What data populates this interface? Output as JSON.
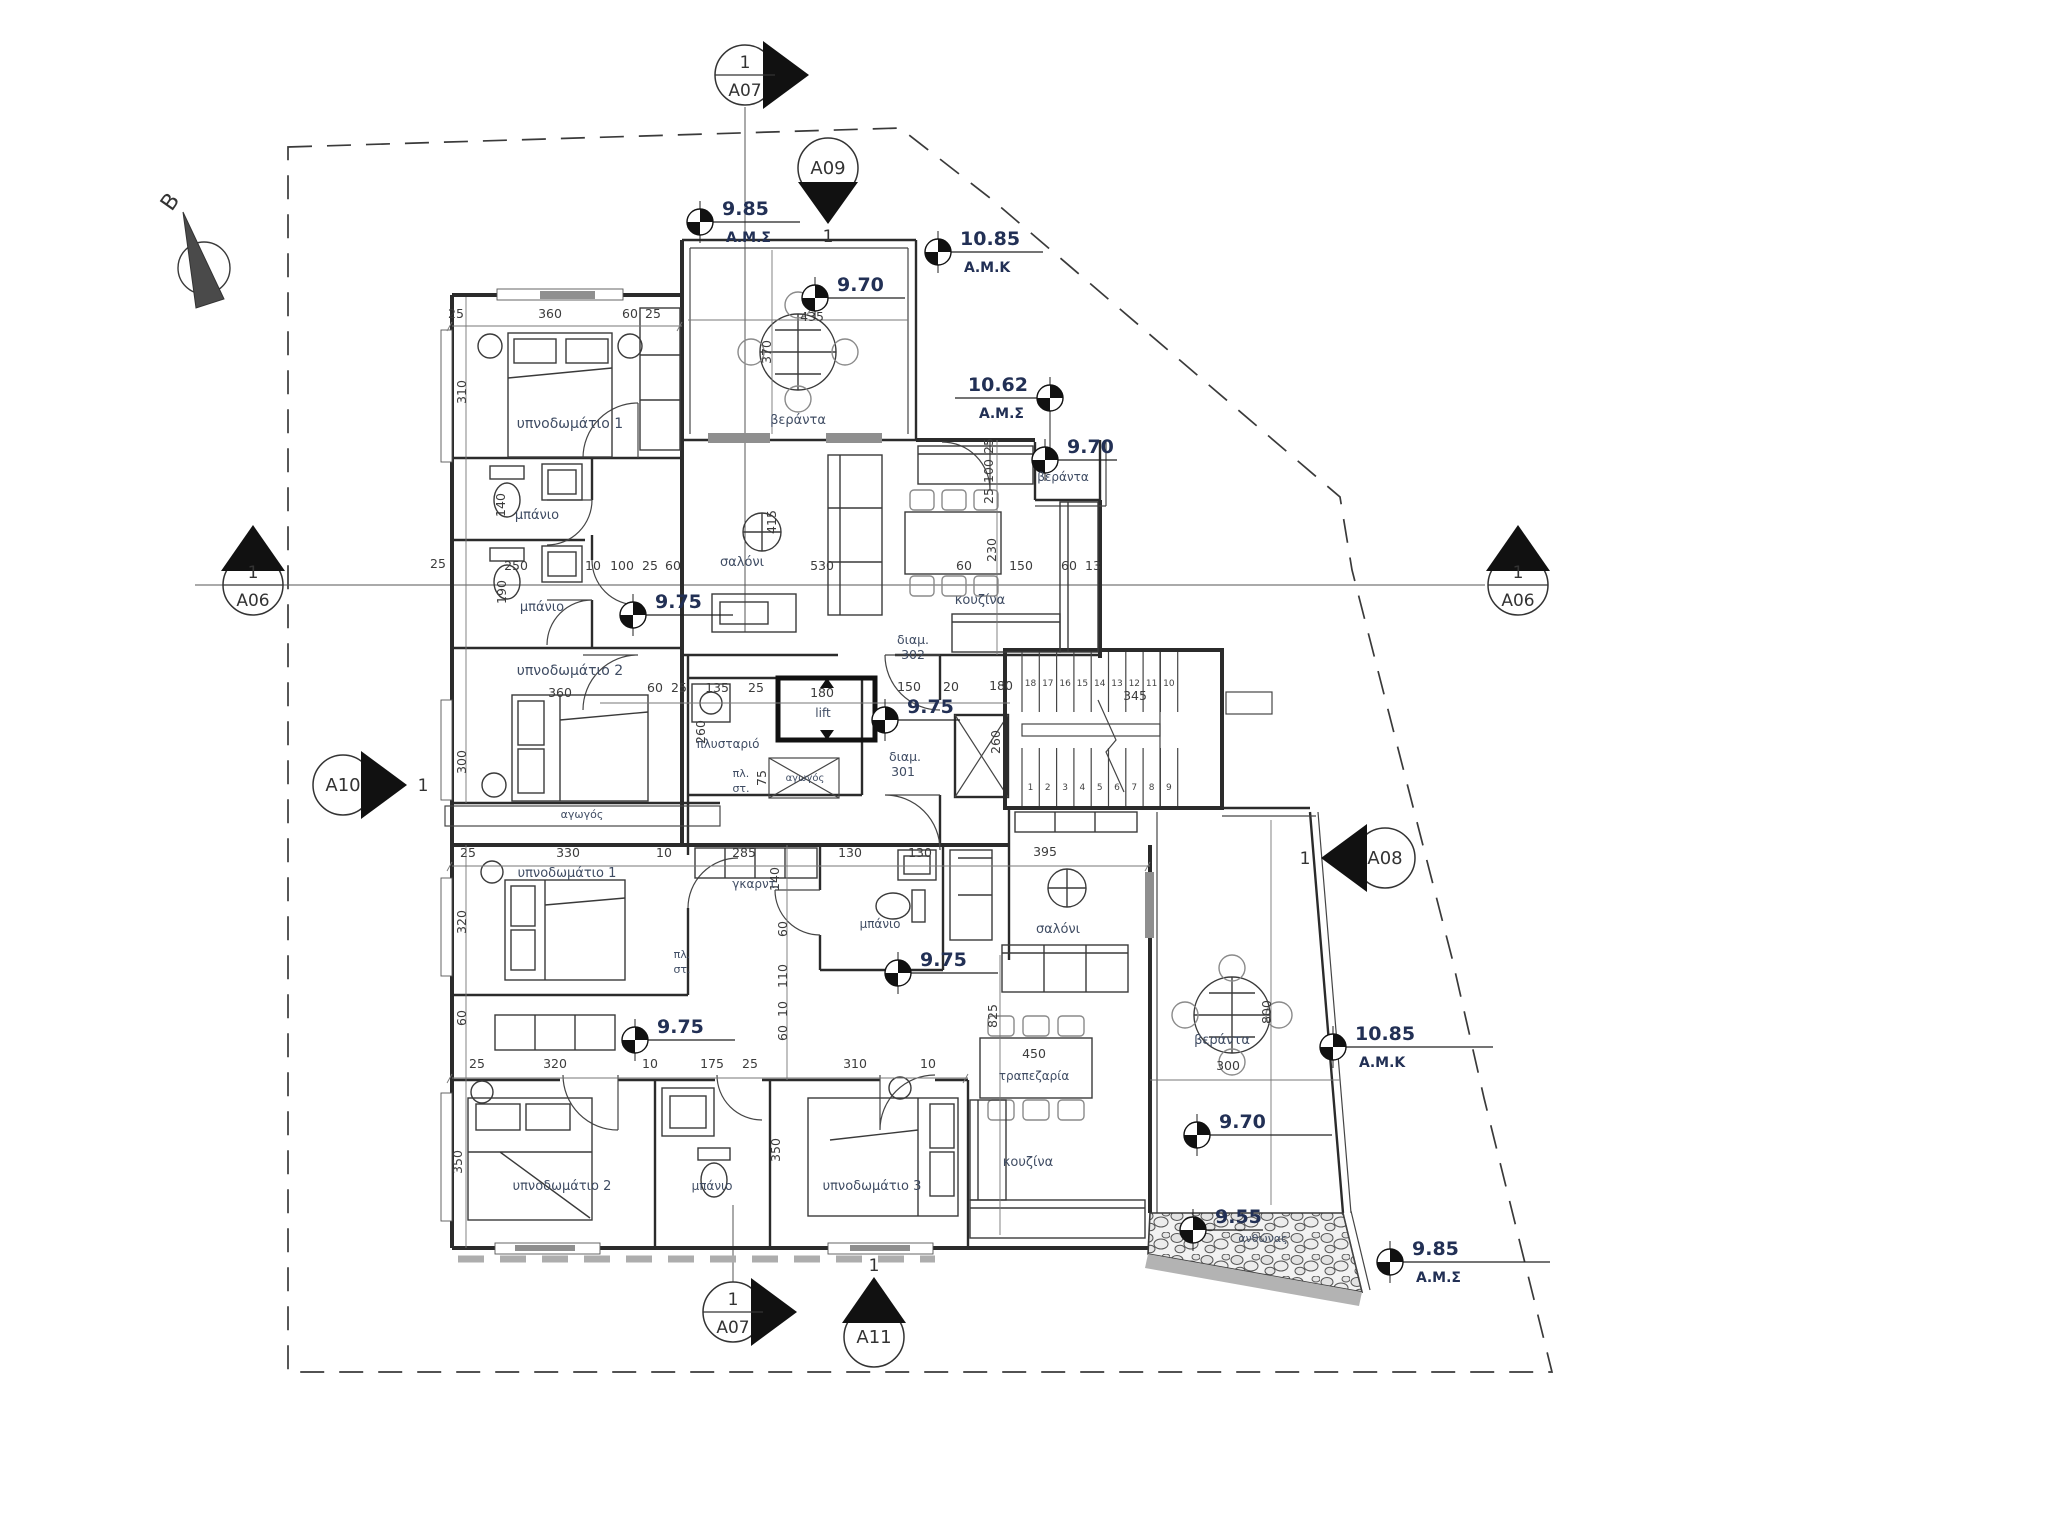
{
  "meta": {
    "kind": "architectural floor plan",
    "language": "Greek"
  },
  "north_arrow": {
    "label": "B"
  },
  "colors": {
    "background": "#ffffff",
    "line": "#2b2b2b",
    "level_text": "#223055",
    "room_label_text": "#3f4c63",
    "dimension_text": "#3c3c3c",
    "gray_fill": "#8f8f8f"
  },
  "apartments": [
    {
      "id_label": "διαμ.",
      "number": "302"
    },
    {
      "id_label": "διαμ.",
      "number": "301"
    }
  ],
  "section_markers": [
    {
      "name": "A07-top",
      "label": "A07",
      "number": "1",
      "x": 745,
      "y": 75,
      "arrow": "right",
      "divided": true,
      "line": [
        745,
        107,
        745,
        632
      ]
    },
    {
      "name": "A09",
      "label": "A09",
      "number": "1",
      "x": 828,
      "y": 168,
      "arrow": "down",
      "divided": false,
      "numpos": "below"
    },
    {
      "name": "A06-left",
      "label": "A06",
      "number": "1",
      "x": 253,
      "y": 585,
      "arrow": "up",
      "divided": true,
      "line": [
        195,
        585,
        1485,
        585
      ]
    },
    {
      "name": "A10",
      "label": "A10",
      "number": "1",
      "x": 343,
      "y": 785,
      "arrow": "right",
      "divided": false,
      "numpos": "right"
    },
    {
      "name": "A06-right",
      "label": "A06",
      "number": "1",
      "x": 1518,
      "y": 585,
      "arrow": "up",
      "divided": true
    },
    {
      "name": "A08",
      "label": "A08",
      "number": "1",
      "x": 1385,
      "y": 858,
      "arrow": "left",
      "divided": false,
      "numpos": "left"
    },
    {
      "name": "A07-bottom",
      "label": "A07",
      "number": "1",
      "x": 733,
      "y": 1312,
      "arrow": "right",
      "divided": true,
      "line": [
        733,
        1282,
        733,
        1205
      ]
    },
    {
      "name": "A11",
      "label": "A11",
      "number": "1",
      "x": 874,
      "y": 1337,
      "arrow": "up",
      "divided": false,
      "numpos": "above"
    }
  ],
  "level_markers": [
    {
      "value": "9.85",
      "datum": "Α.Μ.Σ",
      "x": 700,
      "y": 222,
      "dir": "right",
      "len": 100
    },
    {
      "value": "10.85",
      "datum": "Α.Μ.Κ",
      "x": 938,
      "y": 252,
      "dir": "right",
      "len": 105
    },
    {
      "value": "9.70",
      "datum": "",
      "x": 815,
      "y": 298,
      "dir": "right",
      "len": 90
    },
    {
      "value": "10.62",
      "datum": "Α.Μ.Σ",
      "x": 1050,
      "y": 398,
      "dir": "left",
      "len": 95,
      "drop": 48
    },
    {
      "value": "9.70",
      "datum": "",
      "x": 1045,
      "y": 460,
      "dir": "right",
      "len": 72
    },
    {
      "value": "9.75",
      "datum": "",
      "x": 633,
      "y": 615,
      "dir": "right",
      "len": 100
    },
    {
      "value": "9.75",
      "datum": "",
      "x": 885,
      "y": 720,
      "dir": "right",
      "len": 75
    },
    {
      "value": "9.75",
      "datum": "",
      "x": 898,
      "y": 973,
      "dir": "right",
      "len": 100
    },
    {
      "value": "9.75",
      "datum": "",
      "x": 635,
      "y": 1040,
      "dir": "right",
      "len": 100
    },
    {
      "value": "9.70",
      "datum": "",
      "x": 1197,
      "y": 1135,
      "dir": "right",
      "len": 135
    },
    {
      "value": "10.85",
      "datum": "Α.Μ.Κ",
      "x": 1333,
      "y": 1047,
      "dir": "right",
      "len": 160
    },
    {
      "value": "9.85",
      "datum": "Α.Μ.Σ",
      "x": 1390,
      "y": 1262,
      "dir": "right",
      "len": 160
    },
    {
      "value": "9.55",
      "datum": "",
      "x": 1193,
      "y": 1230,
      "dir": "right",
      "len": 70
    }
  ],
  "room_labels": [
    {
      "text": "υπνοδωμάτιο 1",
      "x": 570,
      "y": 428,
      "s": 14
    },
    {
      "text": "μπάνιο",
      "x": 537,
      "y": 519,
      "s": 13
    },
    {
      "text": "μπάνιο",
      "x": 542,
      "y": 611,
      "s": 13
    },
    {
      "text": "υπνοδωμάτιο 2",
      "x": 570,
      "y": 675,
      "s": 14
    },
    {
      "text": "σαλόνι",
      "x": 742,
      "y": 566,
      "s": 13
    },
    {
      "text": "κουζίνα",
      "x": 980,
      "y": 604,
      "s": 13
    },
    {
      "text": "βεράντα",
      "x": 798,
      "y": 424,
      "s": 13
    },
    {
      "text": "βεράντα",
      "x": 1063,
      "y": 481,
      "s": 12
    },
    {
      "text": "διαμ.",
      "x": 913,
      "y": 644,
      "s": 12.5
    },
    {
      "text": "302",
      "x": 913,
      "y": 659,
      "s": 12.5
    },
    {
      "text": "lift",
      "x": 823,
      "y": 717,
      "s": 12
    },
    {
      "text": "πλυσταριό",
      "x": 728,
      "y": 748,
      "s": 12
    },
    {
      "text": "πλ.",
      "x": 741,
      "y": 777,
      "s": 11
    },
    {
      "text": "στ.",
      "x": 741,
      "y": 792,
      "s": 11
    },
    {
      "text": "αγωγός",
      "x": 805,
      "y": 781,
      "s": 10
    },
    {
      "text": "αγωγός",
      "x": 582,
      "y": 818,
      "s": 11
    },
    {
      "text": "διαμ.",
      "x": 905,
      "y": 761,
      "s": 12.5
    },
    {
      "text": "301",
      "x": 903,
      "y": 776,
      "s": 12.5
    },
    {
      "text": "υπνοδωμάτιο 1",
      "x": 567,
      "y": 877,
      "s": 13
    },
    {
      "text": "γκαρντ.",
      "x": 756,
      "y": 888,
      "s": 12
    },
    {
      "text": "μπάνιο",
      "x": 880,
      "y": 928,
      "s": 12
    },
    {
      "text": "σαλόνι",
      "x": 1058,
      "y": 933,
      "s": 13
    },
    {
      "text": "τραπεζαρία",
      "x": 1034,
      "y": 1080,
      "s": 12
    },
    {
      "text": "κουζίνα",
      "x": 1028,
      "y": 1166,
      "s": 13
    },
    {
      "text": "βεράντα",
      "x": 1222,
      "y": 1044,
      "s": 13
    },
    {
      "text": "υπνοδωμάτιο 2",
      "x": 562,
      "y": 1190,
      "s": 13
    },
    {
      "text": "μπάνιο",
      "x": 712,
      "y": 1190,
      "s": 12
    },
    {
      "text": "υπνοδωμάτιο 3",
      "x": 872,
      "y": 1190,
      "s": 13
    },
    {
      "text": "πλ.",
      "x": 682,
      "y": 958,
      "s": 11
    },
    {
      "text": "στ.",
      "x": 682,
      "y": 973,
      "s": 11
    },
    {
      "text": "ανθώνας",
      "x": 1263,
      "y": 1242,
      "s": 11
    }
  ],
  "dimensions": [
    {
      "t": "25",
      "x": 456,
      "y": 318
    },
    {
      "t": "360",
      "x": 550,
      "y": 318
    },
    {
      "t": "60",
      "x": 630,
      "y": 318
    },
    {
      "t": "25",
      "x": 653,
      "y": 318
    },
    {
      "t": "435",
      "x": 812,
      "y": 321
    },
    {
      "t": "370",
      "x": 771,
      "y": 352,
      "r": 1
    },
    {
      "t": "25",
      "x": 993,
      "y": 446,
      "r": 1
    },
    {
      "t": "100",
      "x": 993,
      "y": 471,
      "r": 1
    },
    {
      "t": "25",
      "x": 993,
      "y": 496,
      "r": 1
    },
    {
      "t": "25",
      "x": 438,
      "y": 568
    },
    {
      "t": "250",
      "x": 516,
      "y": 570
    },
    {
      "t": "10",
      "x": 593,
      "y": 570
    },
    {
      "t": "100",
      "x": 622,
      "y": 570
    },
    {
      "t": "25",
      "x": 650,
      "y": 570
    },
    {
      "t": "60",
      "x": 673,
      "y": 570
    },
    {
      "t": "530",
      "x": 822,
      "y": 570
    },
    {
      "t": "60",
      "x": 964,
      "y": 570
    },
    {
      "t": "150",
      "x": 1021,
      "y": 570
    },
    {
      "t": "60",
      "x": 1069,
      "y": 570
    },
    {
      "t": "13",
      "x": 1093,
      "y": 570
    },
    {
      "t": "310",
      "x": 466,
      "y": 392,
      "r": 1
    },
    {
      "t": "140",
      "x": 505,
      "y": 505,
      "r": 1
    },
    {
      "t": "190",
      "x": 506,
      "y": 592,
      "r": 1
    },
    {
      "t": "300",
      "x": 466,
      "y": 762,
      "r": 1
    },
    {
      "t": "415",
      "x": 776,
      "y": 522,
      "r": 1
    },
    {
      "t": "230",
      "x": 996,
      "y": 550,
      "r": 1
    },
    {
      "t": "360",
      "x": 560,
      "y": 697
    },
    {
      "t": "60",
      "x": 655,
      "y": 692
    },
    {
      "t": "25",
      "x": 679,
      "y": 692
    },
    {
      "t": "135",
      "x": 717,
      "y": 692
    },
    {
      "t": "25",
      "x": 756,
      "y": 692
    },
    {
      "t": "180",
      "x": 822,
      "y": 697
    },
    {
      "t": "150",
      "x": 909,
      "y": 691
    },
    {
      "t": "20",
      "x": 951,
      "y": 691
    },
    {
      "t": "180",
      "x": 1001,
      "y": 690
    },
    {
      "t": "345",
      "x": 1135,
      "y": 700
    },
    {
      "t": "260",
      "x": 705,
      "y": 732,
      "r": 1
    },
    {
      "t": "260",
      "x": 1000,
      "y": 742,
      "r": 1
    },
    {
      "t": "75",
      "x": 766,
      "y": 778,
      "r": 1
    },
    {
      "t": "25",
      "x": 468,
      "y": 857
    },
    {
      "t": "330",
      "x": 568,
      "y": 857
    },
    {
      "t": "10",
      "x": 664,
      "y": 857
    },
    {
      "t": "285",
      "x": 744,
      "y": 857
    },
    {
      "t": "130",
      "x": 850,
      "y": 857
    },
    {
      "t": "130",
      "x": 920,
      "y": 857
    },
    {
      "t": "395",
      "x": 1045,
      "y": 856
    },
    {
      "t": "140",
      "x": 779,
      "y": 879,
      "r": 1
    },
    {
      "t": "60",
      "x": 787,
      "y": 929,
      "r": 1
    },
    {
      "t": "110",
      "x": 787,
      "y": 976,
      "r": 1
    },
    {
      "t": "10",
      "x": 787,
      "y": 1009,
      "r": 1
    },
    {
      "t": "60",
      "x": 787,
      "y": 1033,
      "r": 1
    },
    {
      "t": "320",
      "x": 466,
      "y": 922,
      "r": 1
    },
    {
      "t": "60",
      "x": 466,
      "y": 1018,
      "r": 1
    },
    {
      "t": "350",
      "x": 462,
      "y": 1162,
      "r": 1
    },
    {
      "t": "350",
      "x": 780,
      "y": 1150,
      "r": 1
    },
    {
      "t": "825",
      "x": 997,
      "y": 1016,
      "r": 1
    },
    {
      "t": "800",
      "x": 1271,
      "y": 1012,
      "r": 1
    },
    {
      "t": "25",
      "x": 477,
      "y": 1068
    },
    {
      "t": "320",
      "x": 555,
      "y": 1068
    },
    {
      "t": "10",
      "x": 650,
      "y": 1068
    },
    {
      "t": "175",
      "x": 712,
      "y": 1068
    },
    {
      "t": "25",
      "x": 750,
      "y": 1068
    },
    {
      "t": "310",
      "x": 855,
      "y": 1068
    },
    {
      "t": "10",
      "x": 928,
      "y": 1068
    },
    {
      "t": "450",
      "x": 1034,
      "y": 1058
    },
    {
      "t": "300",
      "x": 1228,
      "y": 1070
    }
  ],
  "stairs": {
    "upper_steps": [
      "18",
      "17",
      "16",
      "15",
      "14",
      "13",
      "12",
      "11",
      "10"
    ],
    "lower_steps": [
      "1",
      "2",
      "3",
      "4",
      "5",
      "6",
      "7",
      "8",
      "9"
    ],
    "run_dimension": "345"
  },
  "lift": {
    "label": "lift",
    "width_dimension": "180"
  }
}
